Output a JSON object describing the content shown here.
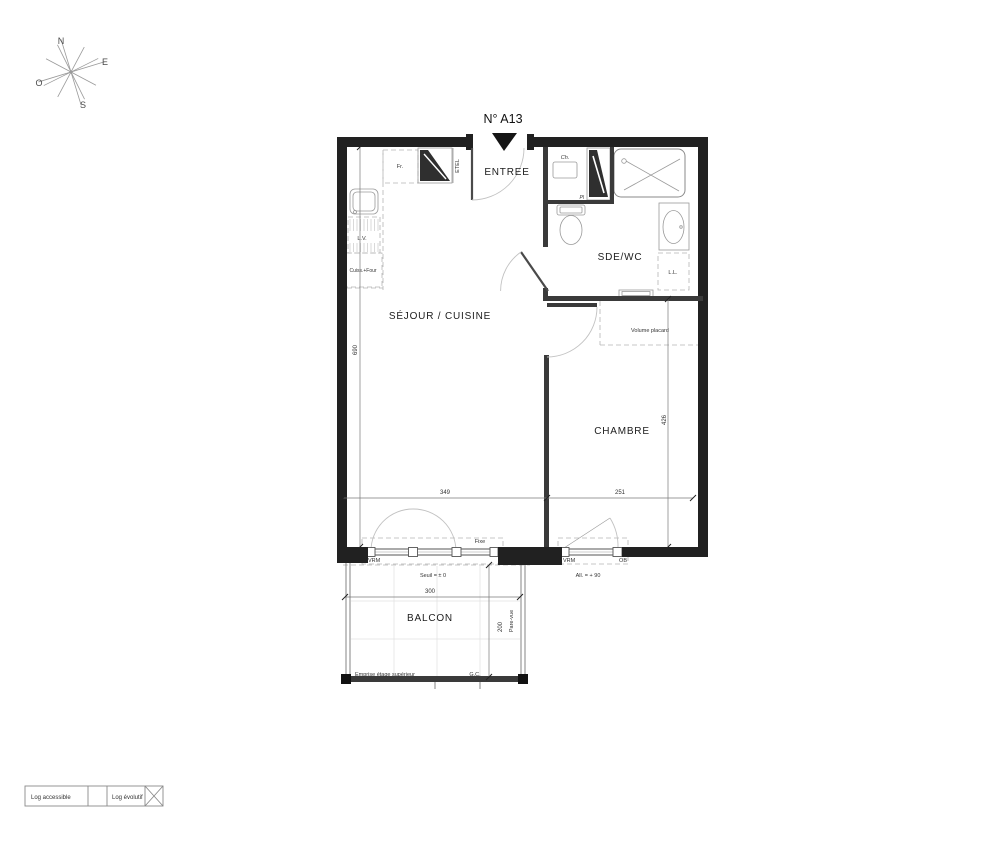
{
  "title": {
    "label": "N° A13"
  },
  "compass": {
    "n": "N",
    "e": "E",
    "o": "O",
    "s": "S"
  },
  "rooms": {
    "entree": "ENTREE",
    "sde_wc": "SDE/WC",
    "sejour_cuisine": "SÉJOUR / CUISINE",
    "chambre": "CHAMBRE",
    "balcon": "BALCON"
  },
  "kitchen": {
    "fridge": "Fr.",
    "dishwasher": "L.V.",
    "cooker": "Cuiss.+Four"
  },
  "entry": {
    "etel": "ETEL"
  },
  "sde": {
    "water_heater": "Ch.",
    "placard": "Pl",
    "washing_machine": "L.L."
  },
  "chambre": {
    "volume_placard": "Volume placard"
  },
  "windows": {
    "sejour": {
      "vrm": "VRM",
      "fixe": "Fixe",
      "seuil": "Seuil = ± 0"
    },
    "chambre": {
      "vrm": "VRM",
      "ob": "OB",
      "allege": "All. = + 90"
    }
  },
  "dims": {
    "sejour_h": "690",
    "sejour_w": "349",
    "chambre_w": "251",
    "chambre_h": "426",
    "balcon_w": "300",
    "balcon_d": "200"
  },
  "balcony": {
    "pare_vue": "Pare-vue",
    "emprise": "Emprise étage supérieur",
    "gc": "G.C."
  },
  "legend": {
    "accessible": "Log accessible",
    "evolutif": "Log évolutif"
  },
  "colors": {
    "wall": "#212121",
    "partition": "#3a3a3a",
    "text": "#222222",
    "line": "#777777",
    "light": "#bbbbbb"
  }
}
